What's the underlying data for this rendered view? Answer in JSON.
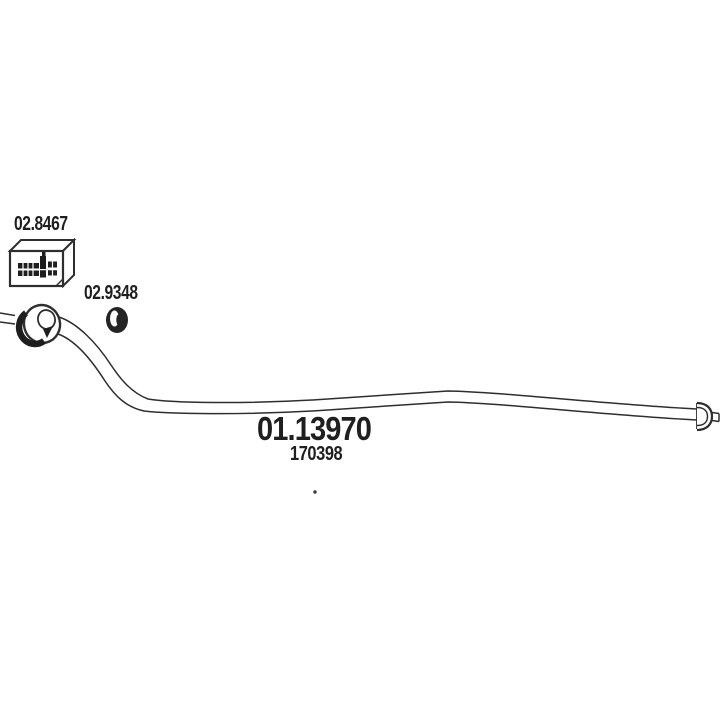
{
  "page": {
    "background_color": "#ffffff",
    "line_color": "#2e2e2e",
    "text_color": "#1f1f1f"
  },
  "diagram": {
    "kind": "exhaust-system-parts-drawing",
    "labels": {
      "mount_code": "02.8467",
      "ring_code": "02.9348",
      "pipe_code": "01.13970",
      "pipe_oe_number": "170398"
    }
  }
}
